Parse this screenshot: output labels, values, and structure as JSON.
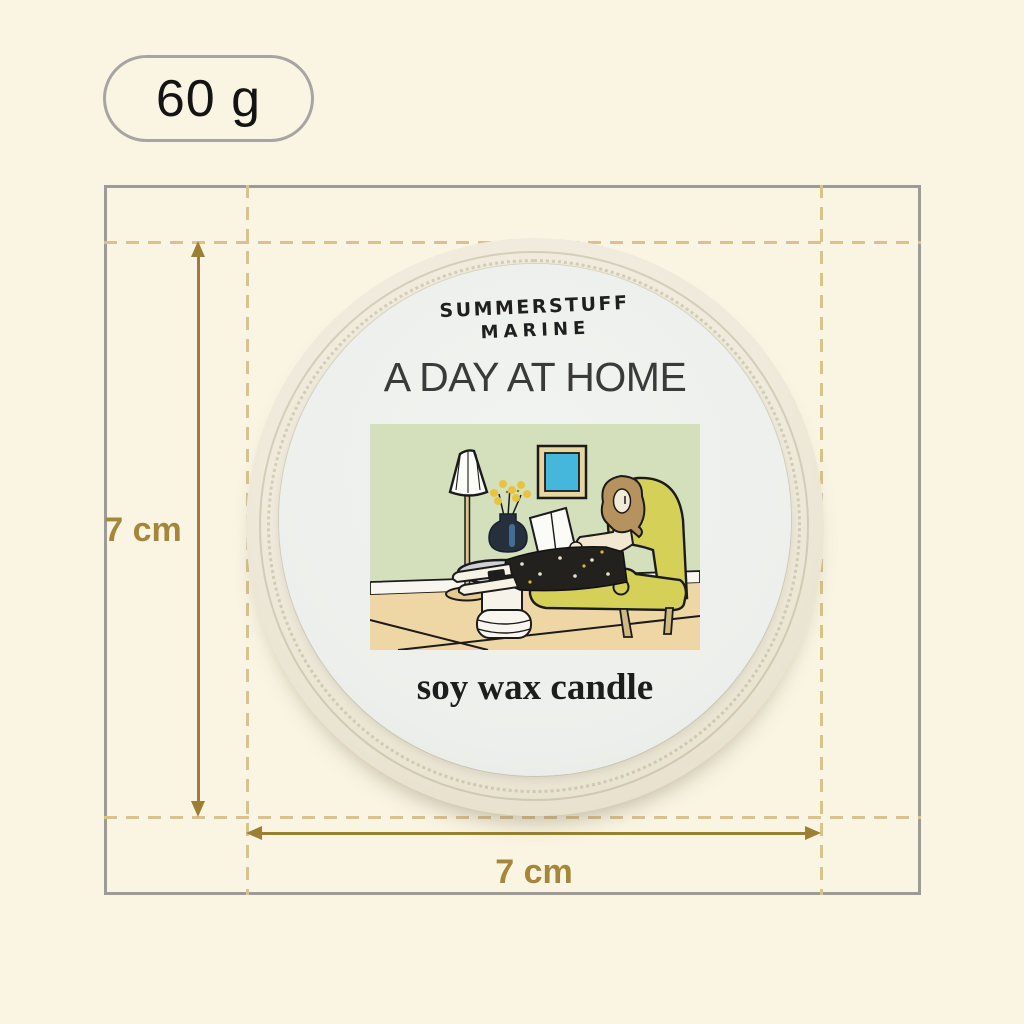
{
  "page": {
    "bg_color": "#FAF5E3"
  },
  "weight_badge": {
    "label": "60 g"
  },
  "measurement": {
    "height_label": "7 cm",
    "width_label": "7 cm",
    "arrow_color": "#9C7F35",
    "dash_color": "#DBC28B",
    "box_border_color": "#9D9A9A",
    "label_color": "#A5873B"
  },
  "product": {
    "brand_line1": "SUMMERSTUFF",
    "brand_line2": "MARINE",
    "title": "A DAY AT HOME",
    "subtitle": "soy wax candle",
    "tin_color": "#EFEADB",
    "label_color": "#EFF1EE",
    "illustration_colors": {
      "wall": "#D4DFBC",
      "floor": "#EED7A5",
      "baseboard": "#F8F6EE",
      "armchair": "#D5D058",
      "picture": "#45B6DC",
      "picture_frame": "#E8D6A0",
      "flowers": "#E8C43E",
      "vase": "#26303C",
      "hair": "#B6935E",
      "skin": "#F2E8D2",
      "lamp_pole": "#DCC28C"
    }
  }
}
